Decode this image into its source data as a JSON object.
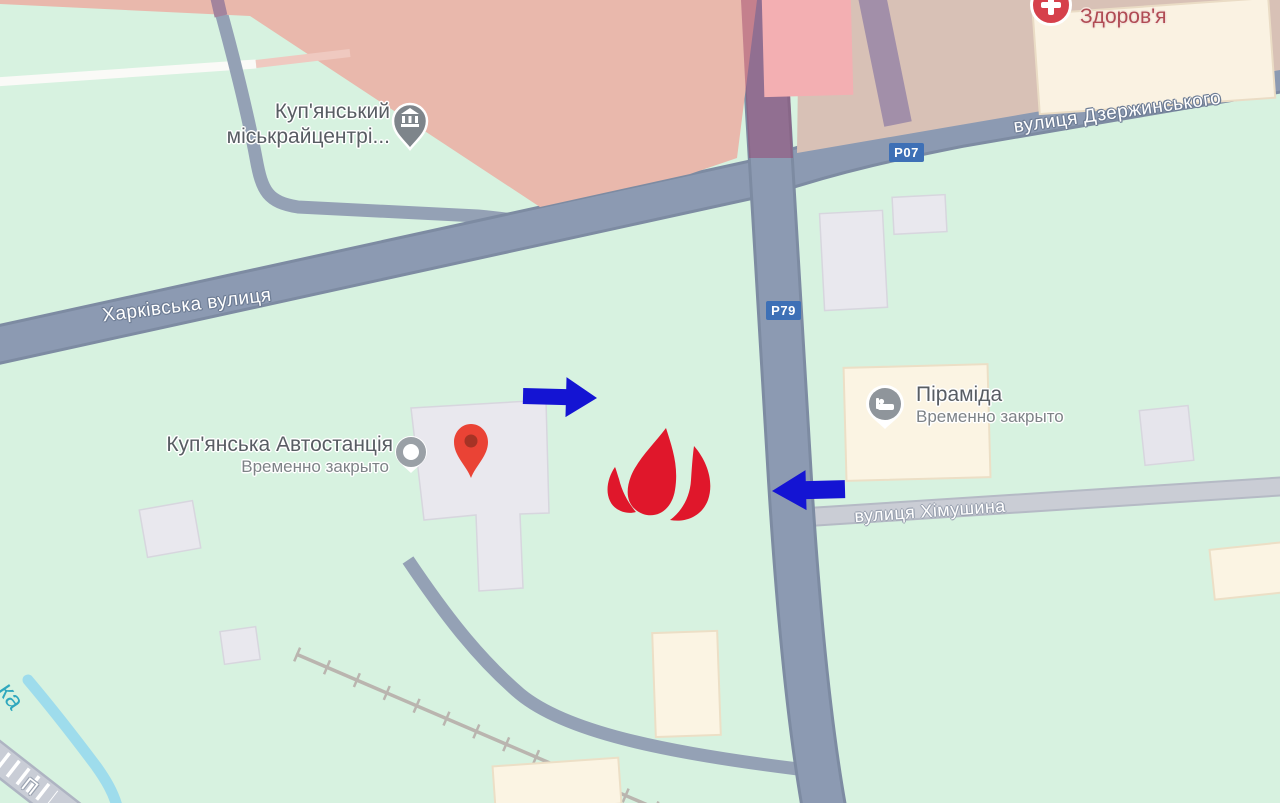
{
  "pois": {
    "city_center": {
      "label_line1": "Куп'янський",
      "label_line2": "міськрайцентрі...",
      "icon": "bank-pin-icon"
    },
    "health_store": {
      "label": "Здоров'я",
      "icon": "health-pin-icon"
    },
    "hotel_pyramid": {
      "label": "Піраміда",
      "status": "Временно закрыто",
      "icon": "hotel-pin-icon"
    },
    "bus_station": {
      "label": "Куп'янська Автостанція",
      "status": "Временно закрыто",
      "icon": "poi-circle-icon"
    }
  },
  "streets": {
    "kharkivska": {
      "label": "Харківська вулиця"
    },
    "dzerzhynskogo": {
      "label": "вулиця Дзержинського"
    },
    "khimushyna": {
      "label": "вулиця Хімушина"
    },
    "corner_partial": {
      "label": "П"
    },
    "river": {
      "label": "ка"
    }
  },
  "route_badges": {
    "p07": {
      "label": "P07"
    },
    "p79": {
      "label": "P79"
    }
  },
  "annotations": {
    "flame_marker": "fire-flame-icon",
    "arrow_right": "blue-arrow-right-icon",
    "arrow_left": "blue-arrow-left-icon",
    "red_pin": "red-location-pin-icon"
  },
  "colors": {
    "background_green": "#d7f2e0",
    "overlay_zone_west": "#e9b8ac",
    "overlay_zone_east": "#d8c1b6",
    "road_fill": "#8c9ab2",
    "road_casing": "#7d8ba2",
    "minor_road_fill": "#cacdd5",
    "water": "#9edcec",
    "badge_blue": "#3e70b6",
    "arrow_blue": "#1414d3",
    "flame_red": "#e0172b",
    "pin_red": "#ea4335"
  }
}
